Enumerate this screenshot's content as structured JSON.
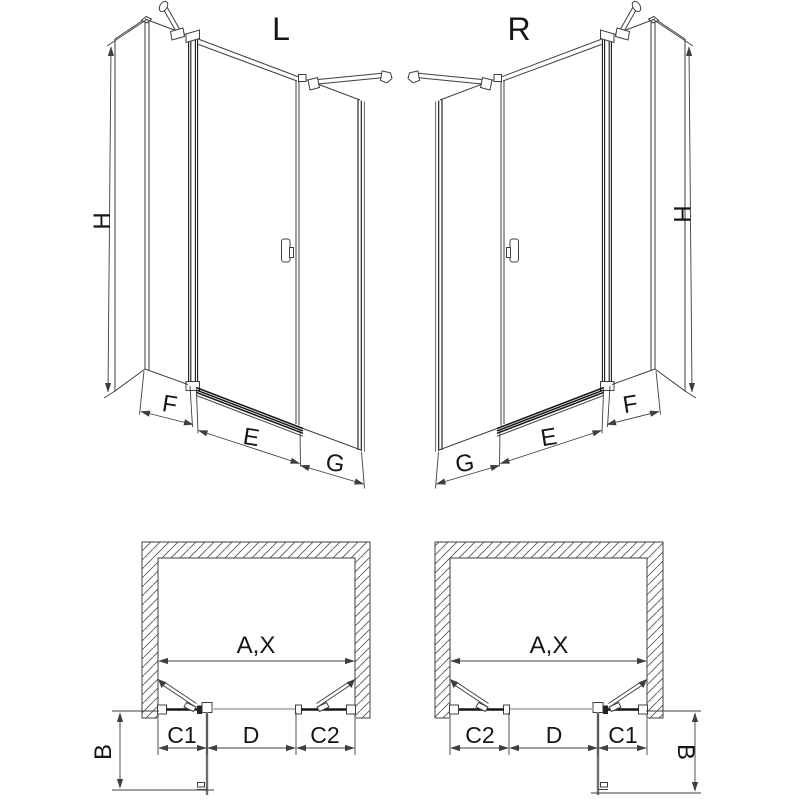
{
  "diagram": {
    "type": "shower-door installation drawing, L and R variants",
    "colors": {
      "line": "#3f3f3f",
      "dark": "#161616",
      "doorOpen": "#6f6f6f",
      "doorClosed": "#bdbdbd",
      "paper": "#ffffff"
    },
    "views": {
      "persp_left": {
        "variant": "L",
        "height": "H",
        "widths": [
          "F",
          "E",
          "G"
        ]
      },
      "persp_right": {
        "variant": "R",
        "height": "H",
        "widths": [
          "G",
          "E",
          "F"
        ]
      },
      "plan_left": {
        "opening": "A,X",
        "segments": [
          "C1",
          "D",
          "C2"
        ],
        "depth": "B"
      },
      "plan_right": {
        "opening": "A,X",
        "segments": [
          "C2",
          "D",
          "C1"
        ],
        "depth": "B"
      }
    }
  }
}
